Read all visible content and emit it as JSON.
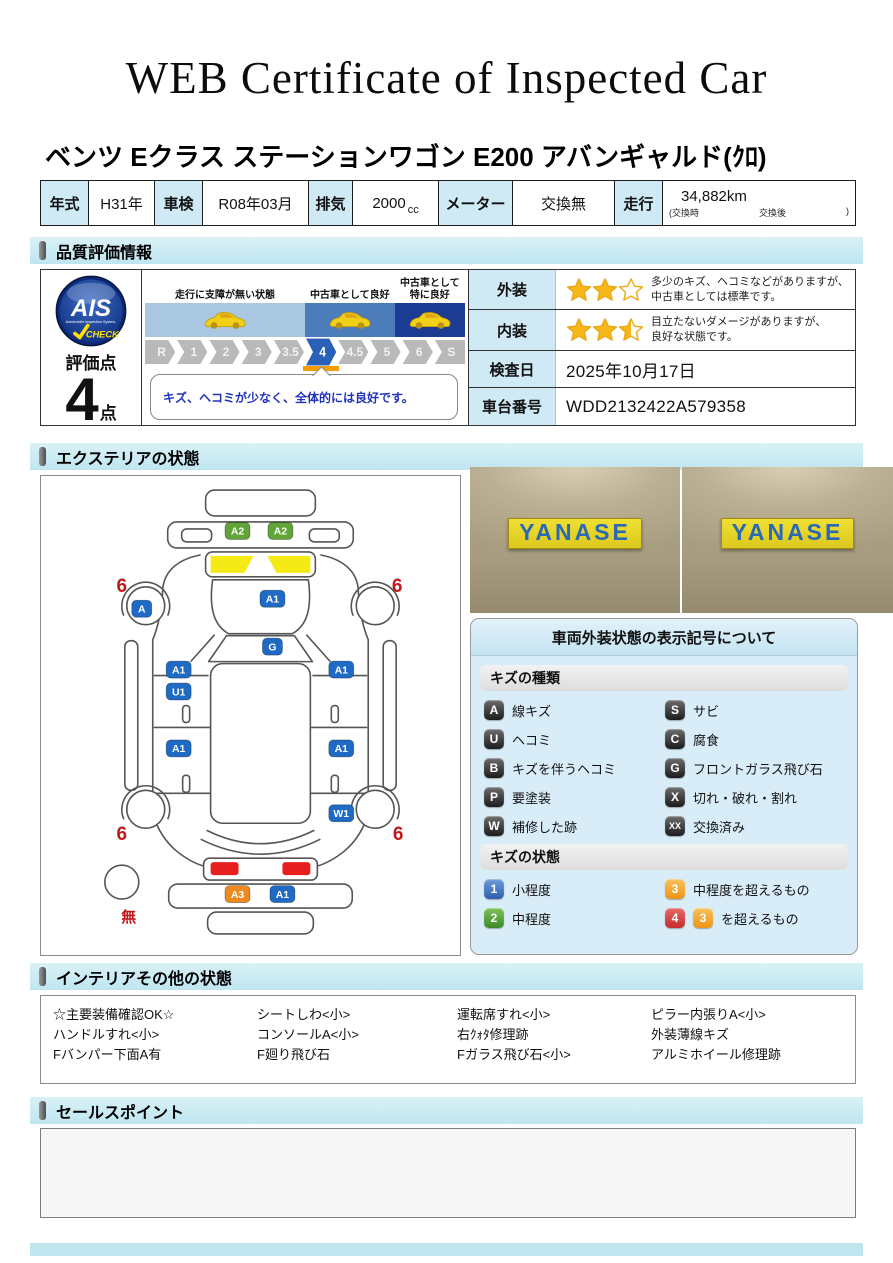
{
  "page": {
    "title": "WEB Certificate of Inspected Car"
  },
  "vehicle": {
    "name": "ベンツ Eクラス ステーションワゴン E200 アバンギャルド(ｸﾛ)"
  },
  "spec_table": {
    "cells": [
      {
        "label": "年式",
        "value": "H31年",
        "type": "simple",
        "lw": 48,
        "vw": 66
      },
      {
        "label": "車検",
        "value": "R08年03月",
        "type": "simple",
        "lw": 48,
        "vw": 106
      },
      {
        "label": "排気",
        "value": "2000",
        "unit": "cc",
        "type": "cc",
        "lw": 44,
        "vw": 86
      },
      {
        "label": "メーター",
        "value": "交換無",
        "type": "simple",
        "lw": 74,
        "vw": 102
      },
      {
        "label": "走行",
        "value": "34,882km",
        "sub_left": "(交換時",
        "sub_mid": "交換後",
        "sub_right": ")",
        "type": "mileage",
        "lw": 48,
        "vw": 0
      }
    ]
  },
  "sections": {
    "quality": "品質評価情報",
    "exterior": "エクステリアの状態",
    "interior": "インテリアその他の状態",
    "sales": "セールスポイント"
  },
  "quality": {
    "ais": {
      "logo_text": "AIS",
      "logo_sub": "Automobile Inspection System,",
      "logo_check": "CHECK",
      "score_label": "評価点",
      "score": "4",
      "score_unit": "点"
    },
    "scale": {
      "zones": [
        {
          "label": "走行に支障が無い状態",
          "color": "#a9c7e0",
          "width": "50%",
          "cars": 1
        },
        {
          "label": "中古車として良好",
          "color": "#4c7cba",
          "width": "28%",
          "cars": 1
        },
        {
          "label": "中古車として\n特に良好",
          "color": "#1c3b92",
          "width": "22%",
          "cars": 1
        }
      ],
      "steps": [
        "R",
        "1",
        "2",
        "3",
        "3.5",
        "4",
        "4.5",
        "5",
        "6",
        "S"
      ],
      "active_index": 5,
      "comment": "キズ、ヘコミが少なく、全体的には良好です。"
    },
    "exterior_row": {
      "label": "外装",
      "stars": 2,
      "line1": "多少のキズ、ヘコミなどがありますが、",
      "line2": "中古車としては標準です。"
    },
    "interior_row": {
      "label": "内装",
      "stars": 2.5,
      "line1": "目立たないダメージがありますが、",
      "line2": "良好な状態です。"
    },
    "inspection_date_row": {
      "label": "検査日",
      "value": "2025年10月17日"
    },
    "vin_row": {
      "label": "車台番号",
      "value": "WDD2132422A579358"
    }
  },
  "exterior_diagram": {
    "badges": [
      {
        "code": "A2",
        "type": "green",
        "x": 197,
        "y": 55
      },
      {
        "code": "A2",
        "type": "green",
        "x": 240,
        "y": 55
      },
      {
        "code": "A",
        "type": "blue",
        "x": 101,
        "y": 133
      },
      {
        "code": "A1",
        "type": "blue",
        "x": 232,
        "y": 123
      },
      {
        "code": "G",
        "type": "blue",
        "x": 232,
        "y": 171
      },
      {
        "code": "A1",
        "type": "blue",
        "x": 138,
        "y": 194
      },
      {
        "code": "U1",
        "type": "blue",
        "x": 138,
        "y": 216
      },
      {
        "code": "A1",
        "type": "blue",
        "x": 301,
        "y": 194
      },
      {
        "code": "A1",
        "type": "blue",
        "x": 138,
        "y": 273
      },
      {
        "code": "A1",
        "type": "blue",
        "x": 301,
        "y": 273
      },
      {
        "code": "W1",
        "type": "blue",
        "x": 301,
        "y": 338
      },
      {
        "code": "A3",
        "type": "orange",
        "x": 197,
        "y": 419
      },
      {
        "code": "A1",
        "type": "blue",
        "x": 242,
        "y": 419
      }
    ],
    "wheel_labels": [
      {
        "text": "6",
        "x": 81,
        "y": 116
      },
      {
        "text": "6",
        "x": 357,
        "y": 116
      },
      {
        "text": "6",
        "x": 81,
        "y": 365
      },
      {
        "text": "6",
        "x": 358,
        "y": 365
      }
    ],
    "spare_label": "無"
  },
  "photos": [
    {
      "sign": "YANASE"
    },
    {
      "sign": "YANASE"
    }
  ],
  "legend": {
    "title": "車両外装状態の表示記号について",
    "kind_header": "キズの種類",
    "kinds": [
      {
        "code": "A",
        "label": "線キズ"
      },
      {
        "code": "S",
        "label": "サビ"
      },
      {
        "code": "U",
        "label": "ヘコミ"
      },
      {
        "code": "C",
        "label": "腐食"
      },
      {
        "code": "B",
        "label": "キズを伴うヘコミ"
      },
      {
        "code": "G",
        "label": "フロントガラス飛び石"
      },
      {
        "code": "P",
        "label": "要塗装"
      },
      {
        "code": "X",
        "label": "切れ・破れ・割れ"
      },
      {
        "code": "W",
        "label": "補修した跡"
      },
      {
        "code": "XX",
        "label": "交換済み"
      }
    ],
    "state_header": "キズの状態",
    "states": [
      {
        "badges": [
          {
            "text": "1",
            "color": "blue"
          }
        ],
        "label": "小程度"
      },
      {
        "badges": [
          {
            "text": "3",
            "color": "orange"
          }
        ],
        "label": "中程度を超えるもの"
      },
      {
        "badges": [
          {
            "text": "2",
            "color": "green"
          }
        ],
        "label": "中程度"
      },
      {
        "badges": [
          {
            "text": "4",
            "color": "red"
          },
          {
            "text": "3",
            "color": "orange"
          }
        ],
        "label": "を超えるもの"
      }
    ]
  },
  "interior_notes": {
    "columns": [
      [
        "☆主要装備確認OK☆",
        "ハンドルすれ<小>",
        "Fバンパー下面A有"
      ],
      [
        "シートしわ<小>",
        "コンソールA<小>",
        "F廻り飛び石"
      ],
      [
        "運転席すれ<小>",
        "右ｸｫﾀ修理跡",
        "Fガラス飛び石<小>"
      ],
      [
        "ピラー内張りA<小>",
        "外装薄線キズ",
        "アルミホイール修理跡"
      ]
    ]
  },
  "sales": {
    "content": ""
  },
  "colors": {
    "accent_teal": "#bfe6ef",
    "label_blue": "#cfeaf5",
    "star_gold": "#f6b71b",
    "badge_blue": "#1e6ac4",
    "badge_green": "#61a437",
    "badge_orange": "#ee8a20",
    "active_step_blue": "#2a61b6",
    "marker_orange": "#f59d00",
    "damage_red": "#c01a1a"
  }
}
